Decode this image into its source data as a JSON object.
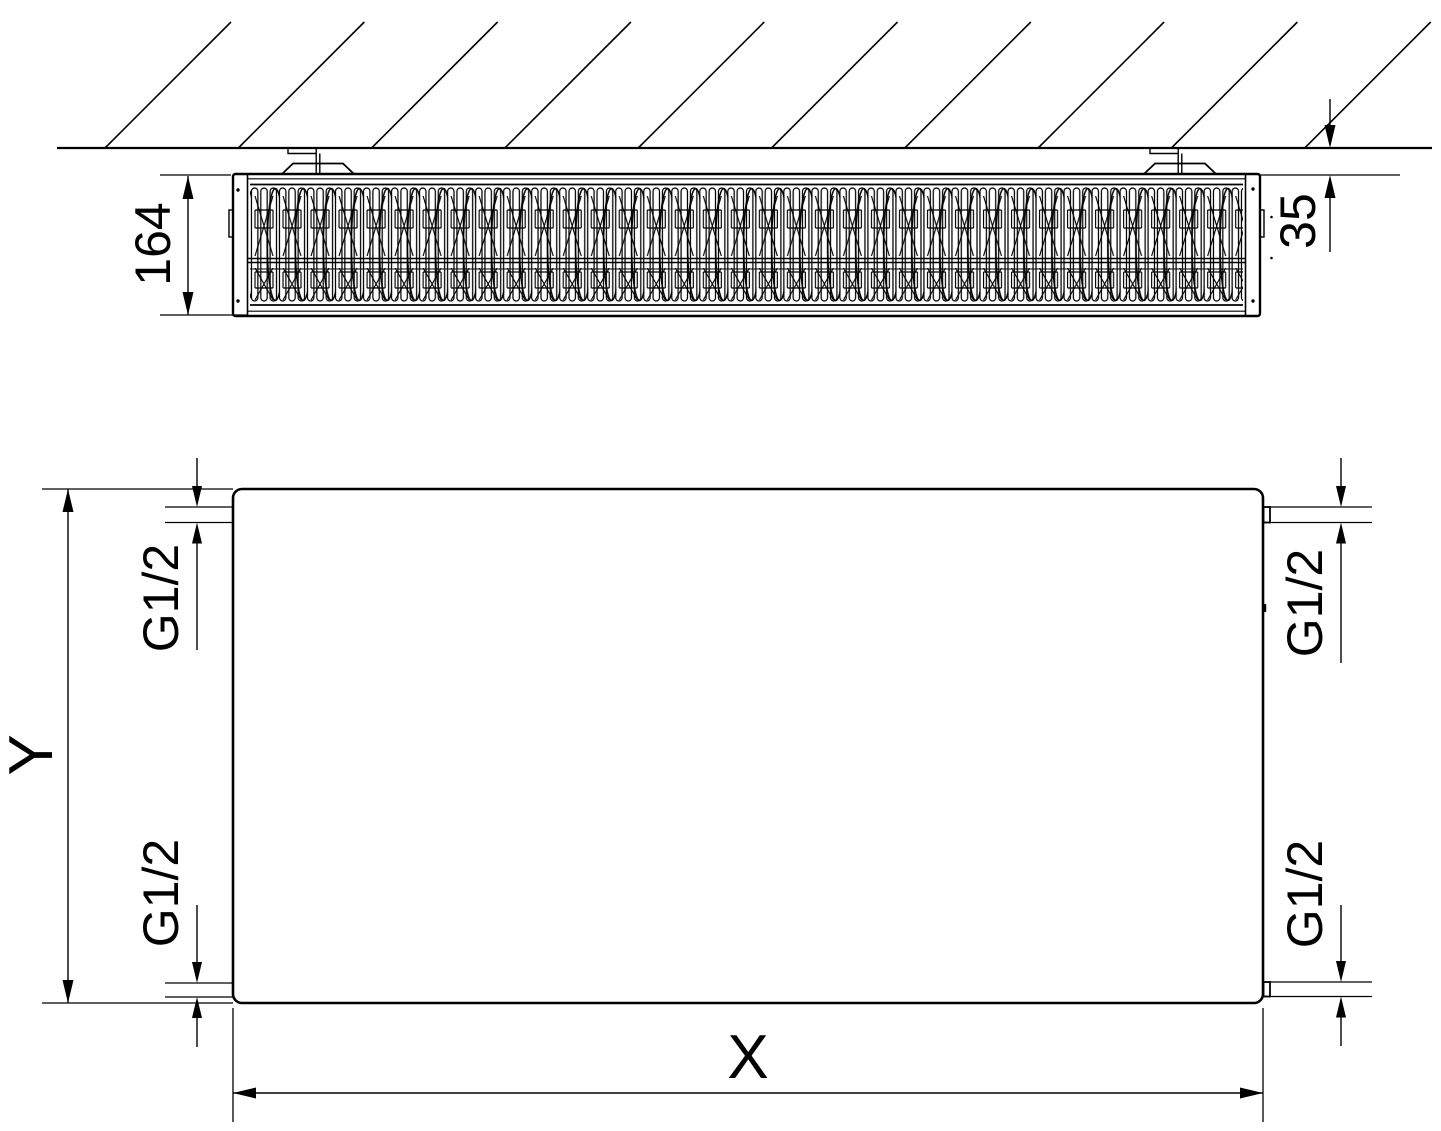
{
  "colors": {
    "line": "#000000",
    "background": "#ffffff"
  },
  "top_view": {
    "depth_label": "164",
    "wall_offset_label": "35"
  },
  "front_view": {
    "height_label": "Y",
    "width_label": "X",
    "connection_top_left_label": "G1/2",
    "connection_top_right_label": "G1/2",
    "connection_bottom_left_label": "G1/2",
    "connection_bottom_right_label": "G1/2"
  }
}
